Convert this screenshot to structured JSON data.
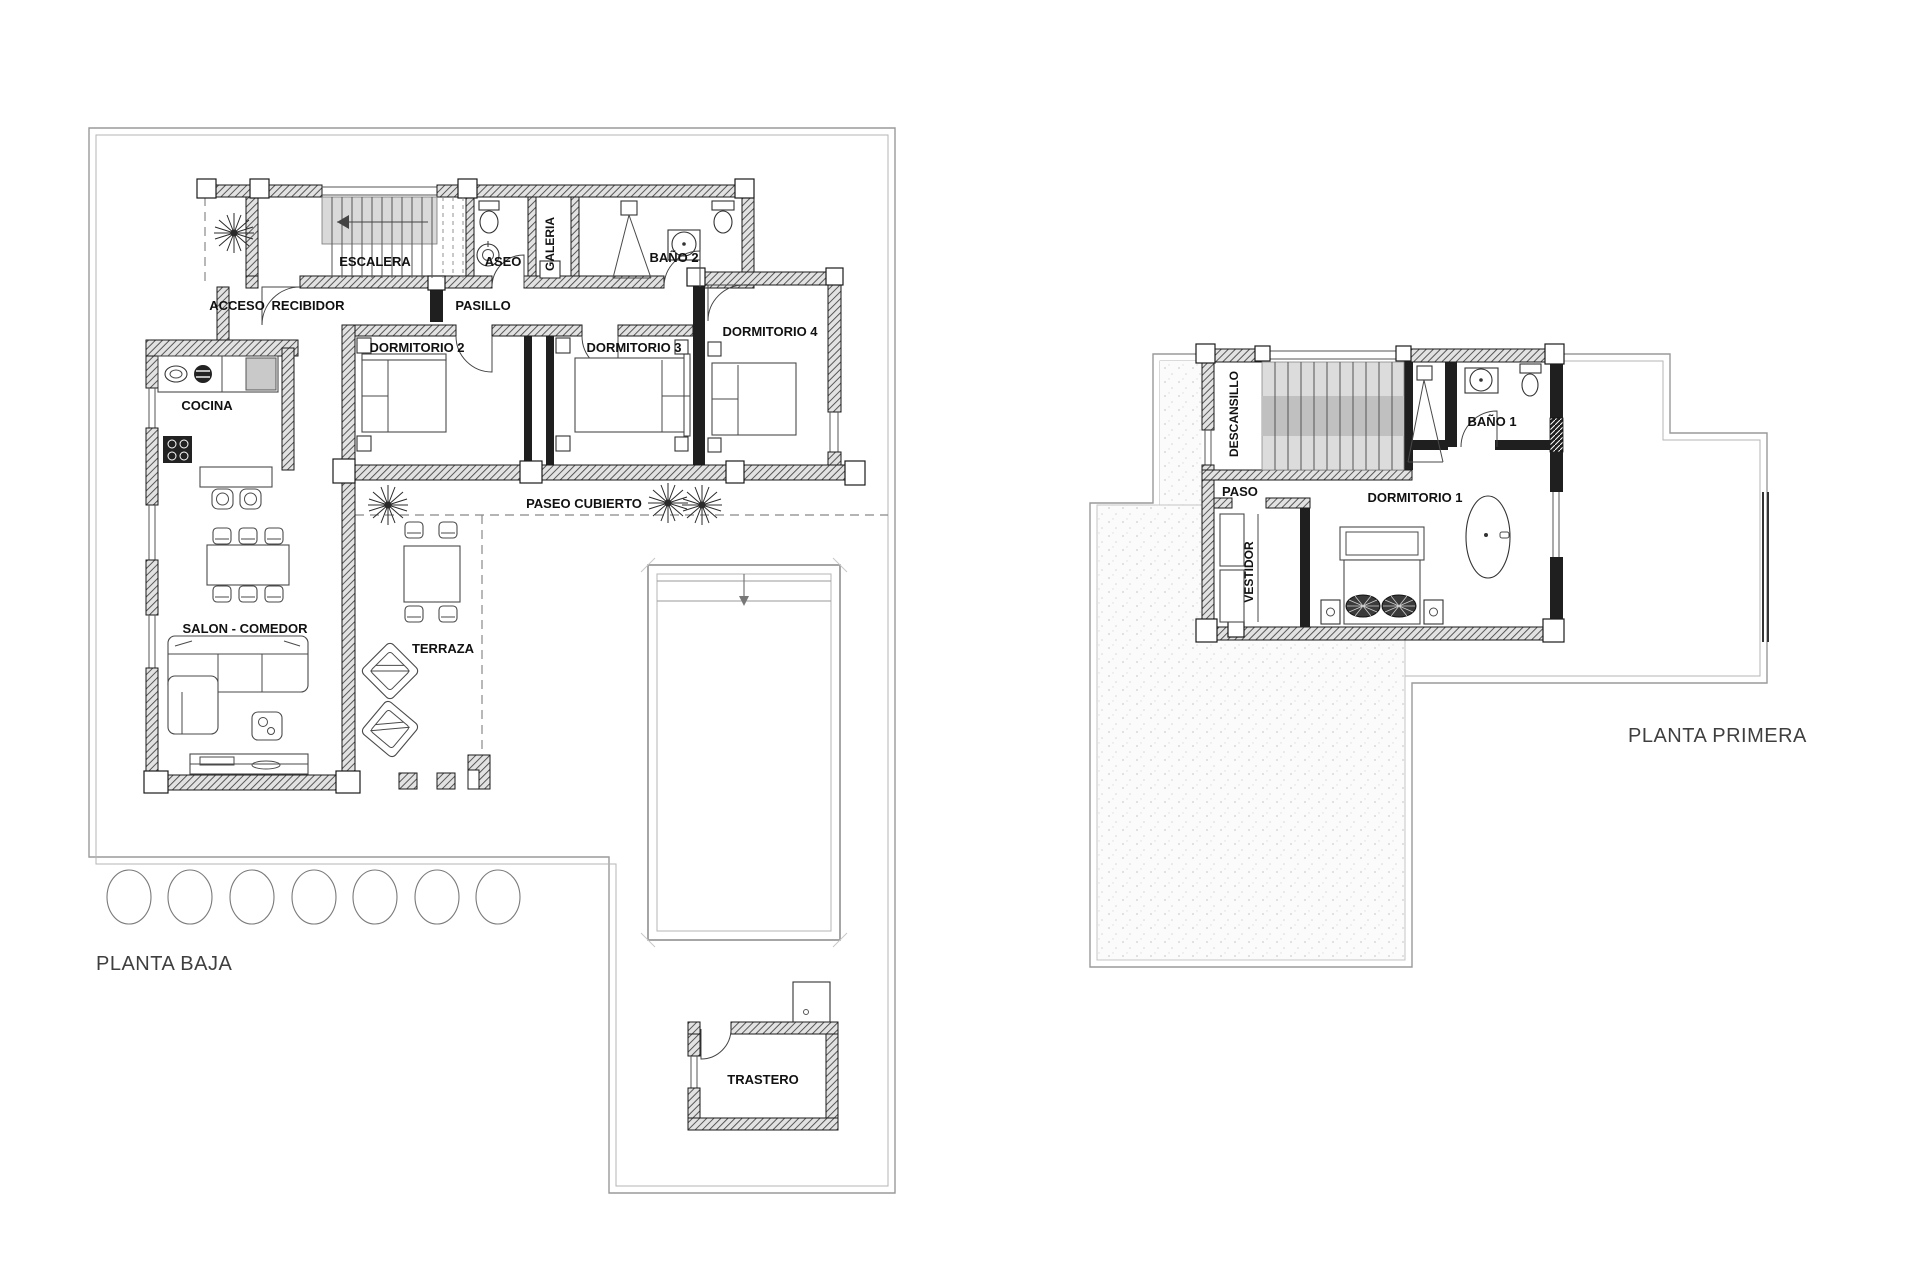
{
  "ground": {
    "title": "PLANTA BAJA",
    "labels": {
      "escalera": "ESCALERA",
      "aseo": "ASEO",
      "galeria": "GALERIA",
      "bano2": "BAÑO 2",
      "acceso": "ACCESO",
      "recibidor": "RECIBIDOR",
      "pasillo": "PASILLO",
      "dormitorio2": "DORMITORIO 2",
      "dormitorio3": "DORMITORIO 3",
      "dormitorio4": "DORMITORIO 4",
      "cocina": "COCINA",
      "salon_comedor": "SALON - COMEDOR",
      "terraza": "TERRAZA",
      "paseo_cubierto": "PASEO CUBIERTO",
      "trastero": "TRASTERO"
    }
  },
  "first": {
    "title": "PLANTA PRIMERA",
    "labels": {
      "descansillo": "DESCANSILLO",
      "bano1": "BAÑO 1",
      "paso": "PASO",
      "dormitorio1": "DORMITORIO 1",
      "vestidor": "VESTIDOR"
    }
  },
  "colors": {
    "wall_line": "#1a1a1a",
    "boundary_line": "#9a9a9a",
    "stair_fill": "#d9d9d9",
    "stair_mid": "#c0c0c0",
    "label_text": "#111111",
    "title_text": "#3f3f3f"
  }
}
